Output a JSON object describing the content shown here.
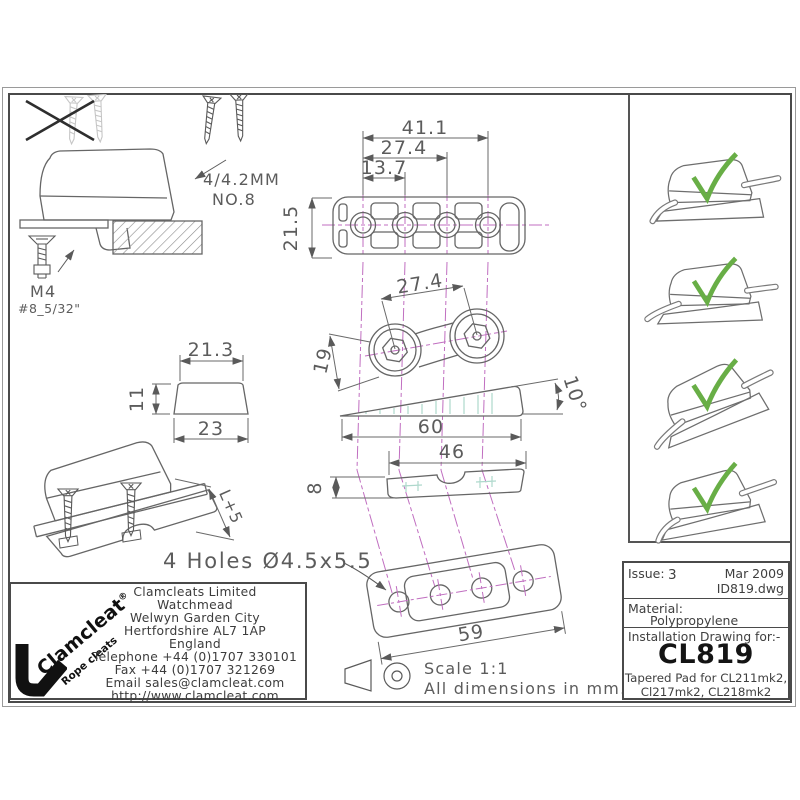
{
  "colors": {
    "line": "#666666",
    "centerline": "#c06ec0",
    "hidden_detail": "#aed8cc",
    "check_green": "#68ae46",
    "logo_black": "#111111"
  },
  "drawing": {
    "no8_note1": "4/4.2MM",
    "no8_note2": "NO.8",
    "m4_label": "M4",
    "m4_sub": "#8_5/32\"",
    "top_view": {
      "d1": "13.7",
      "d2": "27.4",
      "d3": "41.1",
      "height": "21.5"
    },
    "hex_view": {
      "spacing": "27.4",
      "width": "19"
    },
    "wedge_view": {
      "length": "60",
      "angle": "10°"
    },
    "profile_view": {
      "length": "46",
      "thickness": "8"
    },
    "end_view": {
      "top": "21.3",
      "height": "11",
      "bottom": "23"
    },
    "bolt_view": {
      "length": "L+5"
    },
    "holes_note": "4 Holes Ø4.5x5.5",
    "bottom_view": {
      "length": "59"
    },
    "scale_note": "Scale 1:1",
    "units_note": "All dimensions in mm."
  },
  "logo": {
    "brand": "Clamcleat",
    "registered": "®",
    "tagline": "Rope cleats"
  },
  "address": {
    "lines": [
      "Clamcleats Limited",
      "Watchmead",
      "Welwyn Garden City",
      "Hertfordshire AL7 1AP",
      "England",
      "Telephone +44 (0)1707 330101",
      "Fax +44 (0)1707 321269",
      "Email sales@clamcleat.com",
      "http://www.clamcleat.com"
    ]
  },
  "title_block": {
    "issue_label": "Issue:",
    "issue_value": "3",
    "date": "Mar 2009",
    "file": "ID819.dwg",
    "material_label": "Material:",
    "material_value": "Polypropylene",
    "heading": "Installation Drawing for:-",
    "part_number": "CL819",
    "desc1": "Tapered Pad for CL211mk2,",
    "desc2": "Cl217mk2, CL218mk2"
  }
}
